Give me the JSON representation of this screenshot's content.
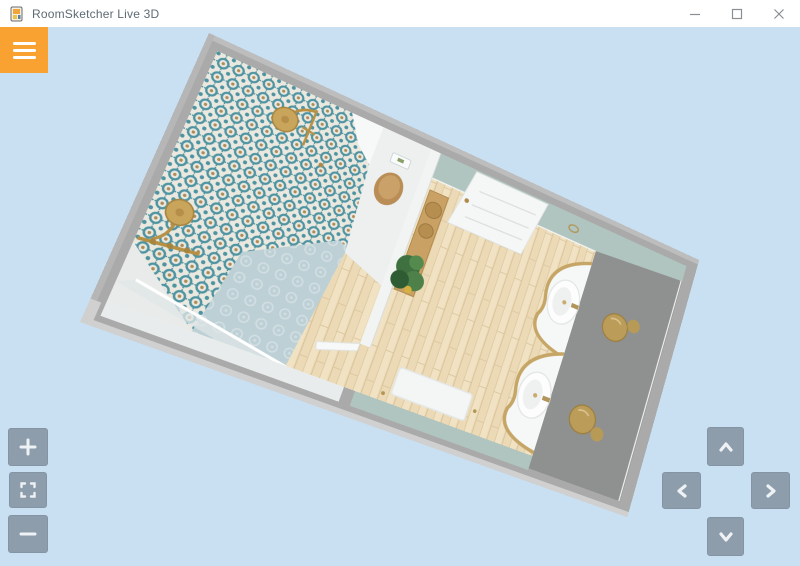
{
  "window": {
    "title": "RoomSketcher Live 3D",
    "app_icon": "roomsketcher-logo-icon",
    "controls": [
      {
        "name": "minimize-button",
        "icon": "minimize-icon"
      },
      {
        "name": "maximize-button",
        "icon": "maximize-icon"
      },
      {
        "name": "close-button",
        "icon": "close-icon"
      }
    ]
  },
  "menu": {
    "icon": "hamburger-menu-icon"
  },
  "viewport_controls": {
    "left_cluster": [
      {
        "name": "zoom-in-button",
        "icon": "plus-icon"
      },
      {
        "name": "fit-view-button",
        "icon": "fit-screen-icon"
      },
      {
        "name": "zoom-out-button",
        "icon": "minus-icon"
      }
    ],
    "right_cluster": [
      {
        "name": "pan-up-button",
        "icon": "chevron-up-icon"
      },
      {
        "name": "pan-left-button",
        "icon": "chevron-left-icon"
      },
      {
        "name": "pan-right-button",
        "icon": "chevron-right-icon"
      },
      {
        "name": "pan-down-button",
        "icon": "chevron-down-icon"
      }
    ]
  },
  "scene": {
    "type": "3d-dollhouse-floorplan",
    "rooms": [
      "shower room with patterned blue tile",
      "bathroom with double vanity"
    ],
    "fixtures": [
      "two brass shower heads",
      "wall-hung toilet with wood seat",
      "white panel door",
      "two curved white vanities with brass taps",
      "two brass wall lamps",
      "ladder shelf with plant",
      "bath mat"
    ]
  },
  "colors": {
    "canvas_background": "#c9e0f2",
    "titlebar_background": "#ffffff",
    "accent_orange": "#f9a232",
    "control_button_gray": "#8d9dac",
    "wall_gray": "#a9aaa9",
    "inner_wall_gray": "#8f9190",
    "tile_teal": "#4d93a2",
    "plain_tile": "#bdd0d5",
    "sage_wall": "#b0c4c0",
    "wood_floor": "#ecdab6",
    "brass": "#c2a261"
  }
}
